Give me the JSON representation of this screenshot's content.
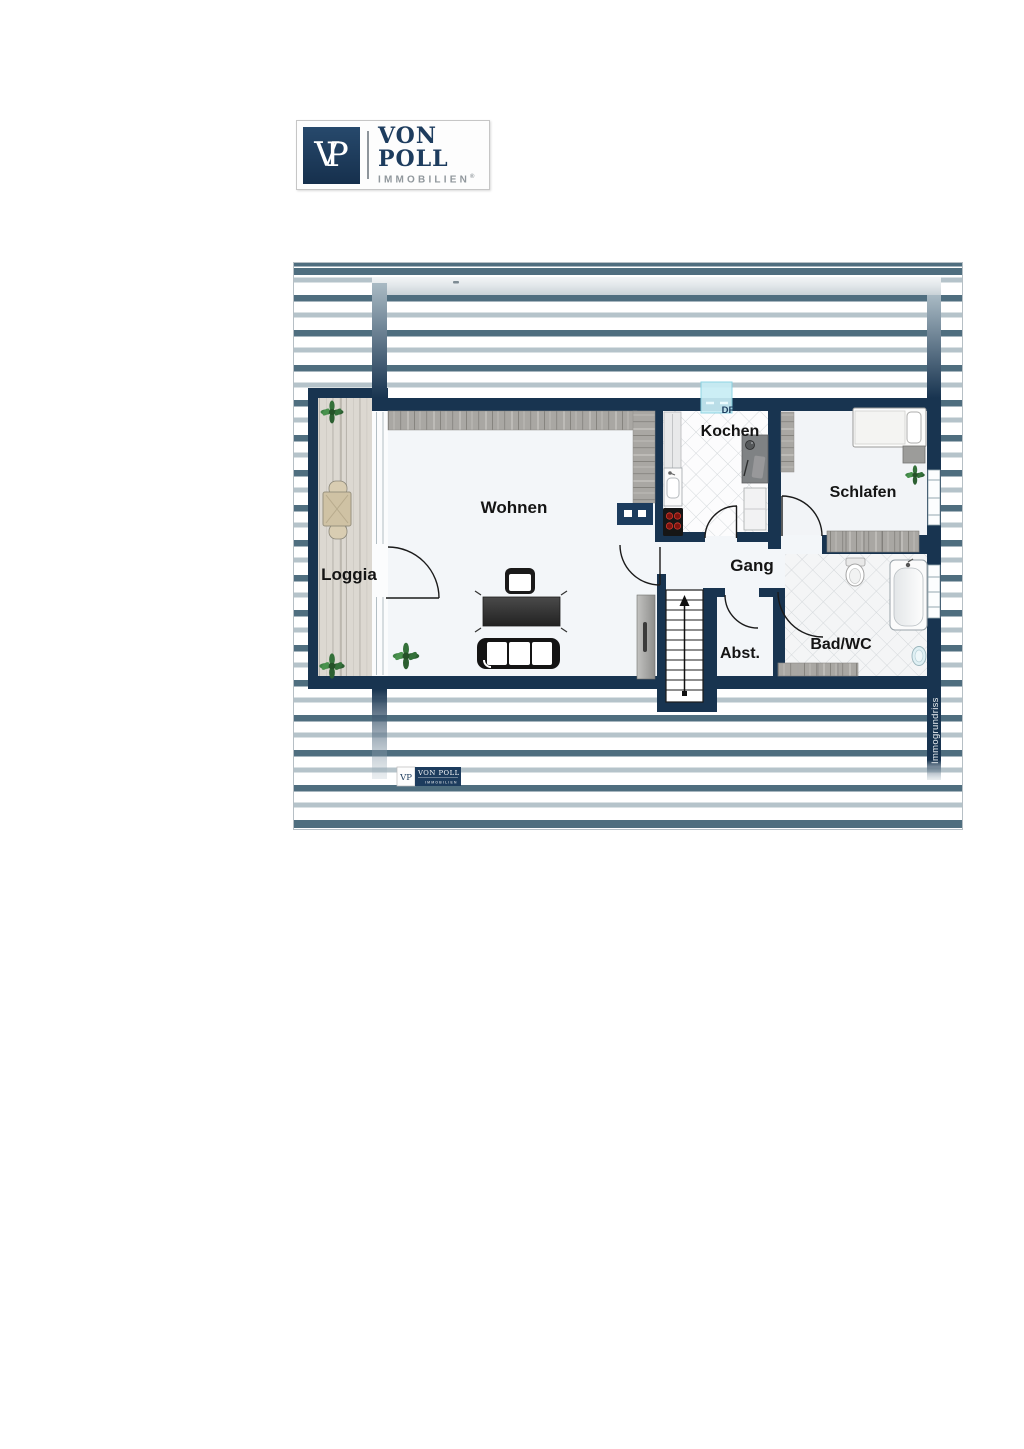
{
  "brand": {
    "monogram_v": "V",
    "monogram_p": "P",
    "name": "VON POLL",
    "subtitle": "IMMOBILIEN",
    "registered": "®"
  },
  "floorplan": {
    "watermark": "Immogrundriss",
    "skylight_label": "DF",
    "rooms": {
      "wohnen": "Wohnen",
      "loggia": "Loggia",
      "kochen": "Kochen",
      "schlafen": "Schlafen",
      "gang": "Gang",
      "abstellraum": "Abst.",
      "bad": "Bad/WC"
    },
    "footer_logo": {
      "monogram": "VP",
      "name": "VON POLL",
      "subtitle": "IMMOBILIEN"
    },
    "colors": {
      "wall": "#183450",
      "stripe_dark": "#4f6e7f",
      "stripe_light": "#b5c3ca",
      "skylight": "#c8edf5",
      "label": "#141414",
      "brand_navy": "#1d3c5e",
      "brand_grey": "#90979c"
    }
  }
}
